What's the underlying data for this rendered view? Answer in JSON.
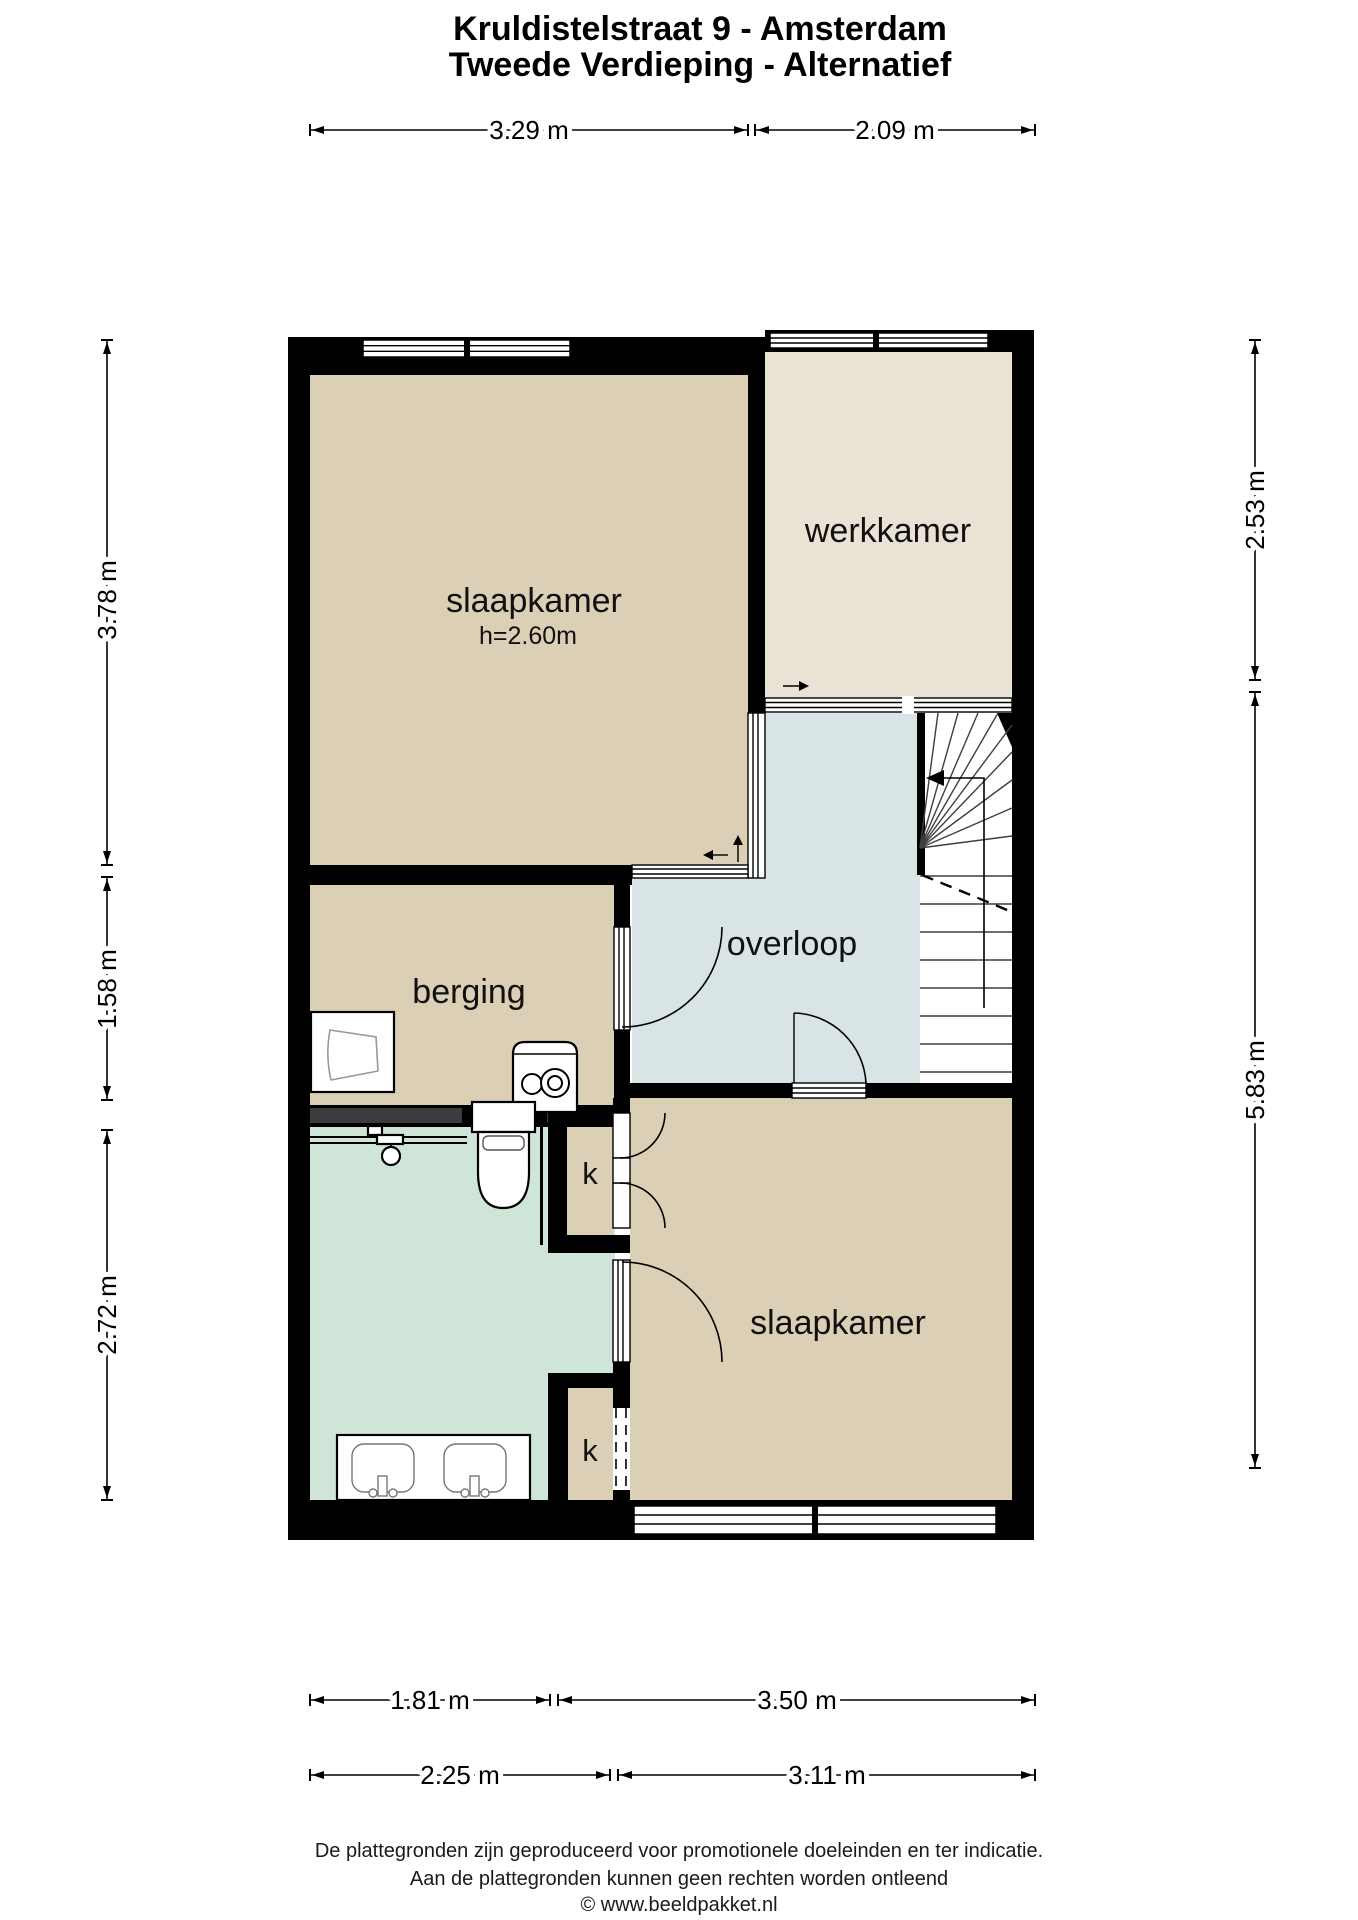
{
  "title": {
    "line1": "Kruldistelstraat 9 - Amsterdam",
    "line2": "Tweede Verdieping - Alternatief"
  },
  "rooms": {
    "slaapkamer1": {
      "label": "slaapkamer",
      "ceiling_height": "h=2.60m"
    },
    "werkkamer": {
      "label": "werkkamer"
    },
    "overloop": {
      "label": "overloop"
    },
    "berging": {
      "label": "berging"
    },
    "closet1": {
      "label": "k"
    },
    "closet2": {
      "label": "k"
    },
    "slaapkamer2": {
      "label": "slaapkamer"
    }
  },
  "dimensions": {
    "top": [
      {
        "label": "3.29 m"
      },
      {
        "label": "2.09 m"
      }
    ],
    "left": [
      {
        "label": "3.78 m"
      },
      {
        "label": "1.58 m"
      },
      {
        "label": "2.72 m"
      }
    ],
    "right": [
      {
        "label": "2.53 m"
      },
      {
        "label": "5.83 m"
      }
    ],
    "bottom_row1": [
      {
        "label": "1.81 m"
      },
      {
        "label": "3.50 m"
      }
    ],
    "bottom_row2": [
      {
        "label": "2.25 m"
      },
      {
        "label": "3.11 m"
      }
    ]
  },
  "footer": {
    "line1": "De plattegronden zijn geproduceerd voor promotionele doeleinden en ter indicatie.",
    "line2": "Aan de plattegronden kunnen geen rechten worden ontleend",
    "line3": "© www.beeldpakket.nl"
  },
  "colors": {
    "room_beige": "#dbcfb5",
    "room_light": "#eae3d5",
    "hallway_blue": "#d8e4e6",
    "bathroom_green": "#cee5d7",
    "wall": "#000000",
    "wall_accent": "#3c3c3c"
  }
}
